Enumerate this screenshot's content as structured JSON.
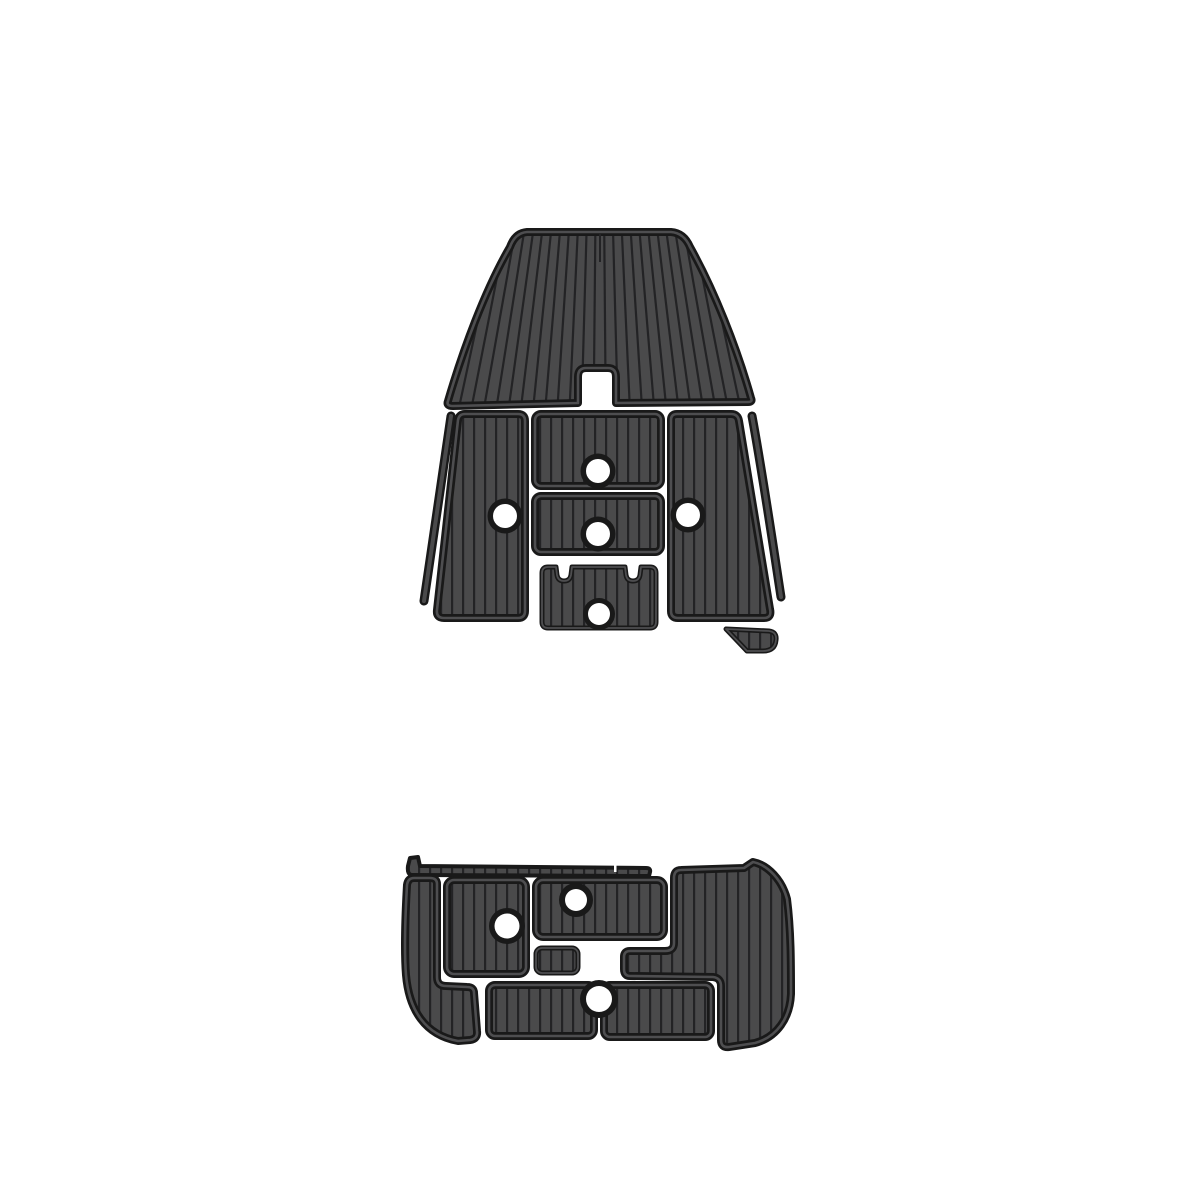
{
  "page": {
    "background": "#ffffff"
  },
  "product_image": {
    "subject": "EVA foam teak-pattern boat decking pad kit, top view of two pad sets on white background",
    "colors": {
      "pad_fill": "#4a4a4b",
      "groove": "#232325",
      "edge": "#191919",
      "edge_gap_line": "#4e4e50",
      "hole": "#ffffff",
      "background": "#ffffff"
    },
    "bow_set": {
      "label": "bow-cockpit-pad-set",
      "pieces": [
        "bow-dome-pad",
        "port-side-panel-pad",
        "starboard-side-panel-pad",
        "center-upper-pad",
        "center-middle-pad",
        "center-notched-pad",
        "port-hull-trim-strip",
        "starboard-hull-trim-strip",
        "stern-corner-wedge-pad"
      ],
      "mount_hole_count": 5
    },
    "platform_set": {
      "label": "swim-platform-pad-set",
      "pieces": [
        "top-edge-trim-strip",
        "port-l-shaped-pad",
        "port-rect-pad",
        "center-upper-pad",
        "center-small-pad",
        "starboard-stepped-pad",
        "bottom-port-pad",
        "bottom-starboard-pad"
      ],
      "mount_hole_count": 3
    }
  }
}
